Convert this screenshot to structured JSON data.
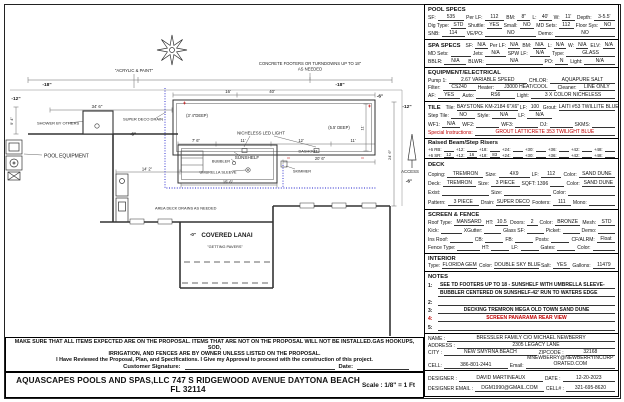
{
  "colors": {
    "red_accent": "#c00000",
    "waterline_blue": "#2020cc"
  },
  "plan": {
    "labels": {
      "acrylic": "\"ACRYLIC & PAINT\"",
      "footers1": "CONCRETE FOOTERS OR TURNDOWNS UP TO 18\"",
      "footers2": "AS NEEDED",
      "m18a": "-18\"",
      "m18b": "-18\"",
      "m12a": "-12\"",
      "m12b": "-12\"",
      "m6a": "-6\"",
      "m6b": "-6\"",
      "m6c": "-6\"",
      "m0": "-0\"",
      "dim346": "34' 6\"",
      "dim40": "40'",
      "dim16": "16'",
      "shower": "SHOWER BY OTHERS",
      "drain": "SUPER DECO DRAIN",
      "poolequip": "POOL EQUIPMENT",
      "deep34": "(3' 4\"DEEP)",
      "deep55": "(5.5' DEEP)",
      "light": "NICHELESS LED LIGHT",
      "dim76": "7' 6\"",
      "dim11a": "11'",
      "dim12": "12'",
      "dim11b": "11'",
      "dim11r": "11'",
      "dashout": "DASHOUT",
      "bubbler": "BUBBLER",
      "sunshelf": "SUNSHELF",
      "dim206": "20' 6\"",
      "umbrella": "UMBRELLA SLEEVE",
      "skimmer": "SKIMMER",
      "dim156": "15' 6\"",
      "deckdrains": "AREA DECK DRAINS AS NEEDED",
      "lanai": "COVERED LANAI",
      "pavers": "\"GETTING PAVERS\"",
      "access": "ACCESS",
      "dim142": "14' 2\"",
      "dim94": "9' 4\"",
      "dim246": "24' 6\""
    }
  },
  "panel": {
    "boxes": [
      {
        "name": "pool-specs",
        "h": 36,
        "title": "POOL SPECS",
        "rows": [
          [
            {
              "l": "SF:",
              "v": "535",
              "f": 1.6
            },
            {
              "l": "Per LF:",
              "v": "112",
              "f": 1.2
            },
            {
              "l": "BM:",
              "v": "8\"",
              "f": 0.8
            },
            {
              "l": "L:",
              "v": "40'",
              "f": 0.8
            },
            {
              "l": "W:",
              "v": "11'",
              "f": 0.8
            },
            {
              "l": "Depth:",
              "v": "3-5.5'",
              "f": 1.3
            }
          ],
          [
            {
              "l": "Dig Type:",
              "v": "STD",
              "f": 1
            },
            {
              "l": "Shuttle:",
              "v": "YES",
              "f": 1
            },
            {
              "l": "Small:",
              "v": "NO",
              "f": 1
            },
            {
              "l": "MD Sets:",
              "v": "112",
              "f": 1
            },
            {
              "l": "Floor Sys:",
              "v": "NO",
              "f": 1
            }
          ],
          [
            {
              "l": "SNB:",
              "v": "114",
              "f": 1
            },
            {
              "l": "VE/PO:",
              "v": "NO",
              "f": 2.2
            },
            {
              "l": "Demo:",
              "v": "NO",
              "f": 2.6
            }
          ]
        ]
      },
      {
        "name": "spa-specs",
        "h": 29,
        "rows": [
          [
            {
              "t": "SPA SPECS"
            },
            {
              "l": "SF:",
              "v": "N/A",
              "f": 1
            },
            {
              "l": "Per LF:",
              "v": "N/A",
              "f": 1
            },
            {
              "l": "BM:",
              "v": "N/A",
              "f": 1
            },
            {
              "l": "L:",
              "v": "N/A",
              "f": 1
            },
            {
              "l": "W:",
              "v": "N/A",
              "f": 1
            },
            {
              "l": "ELV:",
              "v": "N/A",
              "f": 1
            }
          ],
          [
            {
              "l": "MD Sets:",
              "v": "",
              "f": 1
            },
            {
              "l": "Jets:",
              "v": "N/A",
              "f": 1
            },
            {
              "l": "SPW LF:",
              "v": "N/A",
              "f": 1
            },
            {
              "l": "Type:",
              "v": "GLASS",
              "f": 2.4
            }
          ],
          [
            {
              "l": "BBLR:",
              "v": "N/A",
              "f": 1
            },
            {
              "l": "BLWR:",
              "v": "N/A",
              "f": 2.6
            },
            {
              "l": "PO:",
              "v": "N",
              "f": 0.6
            },
            {
              "l": "Light:",
              "v": "N/A",
              "f": 1.4
            }
          ]
        ]
      },
      {
        "name": "equipment-electrical",
        "h": 35,
        "title": "EQUIPMENT/ELECTRICAL",
        "rows": [
          [
            {
              "l": "Pump 1:",
              "v": "2.67 VARIABLE SPEED",
              "f": 2.4
            },
            {
              "l": "CHLOR:",
              "v": "AQUAPURE SALT",
              "f": 2
            }
          ],
          [
            {
              "l": "Filter:",
              "v": "CS240",
              "f": 1
            },
            {
              "l": "Heater:",
              "v": "J3000 HEAT/COOL",
              "f": 1.8
            },
            {
              "l": "Cleaner:",
              "v": "LINE ONLY",
              "f": 1.1
            }
          ],
          [
            {
              "l": "AF:",
              "v": "YES",
              "f": 0.7
            },
            {
              "l": "Auto:",
              "v": "RS6",
              "f": 1.2
            },
            {
              "l": "Light:",
              "v": "3 X COLOR NICHELESS",
              "f": 2.6
            }
          ]
        ]
      },
      {
        "name": "tile",
        "h": 38,
        "rows": [
          [
            {
              "t": "TILE"
            },
            {
              "l": "Tile:",
              "v": "BAYSTONE KM-2184 6\"X6\"",
              "f": 2.6
            },
            {
              "l": "LF:",
              "v": "100",
              "f": 0.5
            },
            {
              "l": "Grout:",
              "v": "LAITI #53 TWILLITE BLUE",
              "f": 2.4
            }
          ],
          [
            {
              "l": "Step Tile:",
              "v": "NO",
              "f": 0.8
            },
            {
              "l": "Style:",
              "v": "N/A",
              "f": 0.8
            },
            {
              "l": "LF:",
              "v": "N/A",
              "f": 0.8
            },
            {
              "l": "",
              "v": "",
              "f": 2
            }
          ],
          [
            {
              "l": "WF1:",
              "v": "N/A",
              "f": 0.8
            },
            {
              "l": "WF2:",
              "v": "",
              "f": 1
            },
            {
              "l": "WF3:",
              "v": "",
              "f": 1
            },
            {
              "l": "DJ:",
              "v": "",
              "f": 1
            },
            {
              "l": "SKMS:",
              "v": "",
              "f": 1
            }
          ],
          [
            {
              "l": "Special Instructions:",
              "lc": "#c00000",
              "v": "GROUT LATTICRETE 353 TWILIGHT BLUE",
              "vc": "#c00000",
              "f": 1
            }
          ]
        ]
      },
      {
        "name": "raised-beam-step-risers",
        "h": 21,
        "title": "Raised Beam/Step Risers",
        "cls": "tiny",
        "rows": [
          [
            {
              "l": "+6 RB:",
              "v": "",
              "f": 1
            },
            {
              "l": "+12:",
              "v": "",
              "f": 1
            },
            {
              "l": "+18:",
              "v": "",
              "f": 1
            },
            {
              "l": "+24:",
              "v": "",
              "f": 1
            },
            {
              "l": "+30:",
              "v": "",
              "f": 1
            },
            {
              "l": "+36:",
              "v": "",
              "f": 1
            },
            {
              "l": "+42:",
              "v": "",
              "f": 1
            },
            {
              "l": "+48:",
              "v": "",
              "f": 1
            }
          ],
          [
            {
              "l": "+6 SR:",
              "v": "12",
              "f": 1
            },
            {
              "l": "+12:",
              "v": "16",
              "f": 1
            },
            {
              "l": "+18:",
              "v": "83",
              "f": 1
            },
            {
              "l": "+24:",
              "v": "",
              "f": 1
            },
            {
              "l": "+30:",
              "v": "",
              "f": 1
            },
            {
              "l": "+36:",
              "v": "",
              "f": 1
            },
            {
              "l": "+42:",
              "v": "",
              "f": 1
            },
            {
              "l": "+48:",
              "v": "",
              "f": 1
            }
          ]
        ]
      },
      {
        "name": "deck",
        "h": 52,
        "title": "DECK",
        "rows": [
          [
            {
              "l": "Coping:",
              "v": "TREMRON",
              "f": 1.4
            },
            {
              "l": "Size:",
              "v": "4X9",
              "f": 1.2
            },
            {
              "l": "LF:",
              "v": "112",
              "f": 0.8
            },
            {
              "l": "Color:",
              "v": "SAND DUNE",
              "f": 1.4
            }
          ],
          [
            {
              "l": "Deck:",
              "v": "TREMRON",
              "f": 1.4
            },
            {
              "l": "Size:",
              "v": "3 PIECE",
              "f": 1.2
            },
            {
              "l": "SQFT: 1396",
              "v": "",
              "f": 0.6
            },
            {
              "l": "Color:",
              "v": "SAND DUNE",
              "f": 1.4
            }
          ],
          [
            {
              "l": "Exist:",
              "v": "",
              "f": 1.4
            },
            {
              "l": "Size:",
              "v": "",
              "f": 1.4
            },
            {
              "l": "Color:",
              "v": "",
              "f": 1.4
            }
          ],
          [
            {
              "l": "Pattern:",
              "v": "3 PIECE",
              "f": 1.2
            },
            {
              "l": "Drain:",
              "v": "SUPER DECO",
              "f": 1.3
            },
            {
              "l": "Footers:",
              "v": "111",
              "f": 0.7
            },
            {
              "l": "Mono:",
              "v": "",
              "f": 1
            }
          ]
        ]
      },
      {
        "name": "screen-fence",
        "h": 45,
        "title": "SCREEN & FENCE",
        "rows": [
          [
            {
              "l": "Roof Type:",
              "v": "MANSARD",
              "f": 1.4
            },
            {
              "l": "HT:",
              "v": "10.5",
              "f": 0.6
            },
            {
              "l": "Doors:",
              "v": "2",
              "f": 0.5
            },
            {
              "l": "Color:",
              "v": "BRONZE",
              "f": 1.2
            },
            {
              "l": "Mesh:",
              "v": "STD",
              "f": 0.8
            }
          ],
          [
            {
              "l": "Kick:",
              "v": "",
              "f": 1
            },
            {
              "l": "XGutter:",
              "v": "",
              "f": 0.8
            },
            {
              "l": "Glass SF:",
              "v": "",
              "f": 0.8
            },
            {
              "l": "Picket:",
              "v": "",
              "f": 0.8
            },
            {
              "l": "Demo:",
              "v": "",
              "f": 0.8
            }
          ],
          [
            {
              "l": "Ins Roof:",
              "v": "",
              "f": 1
            },
            {
              "l": "CB:",
              "v": "",
              "f": 0.8
            },
            {
              "l": "FB:",
              "v": "",
              "f": 0.8
            },
            {
              "l": "Posts:",
              "v": "",
              "f": 0.8
            },
            {
              "l": "CF/ALRM:",
              "v": "Float",
              "f": 0.8
            }
          ],
          [
            {
              "l": "Fence Type:",
              "v": "",
              "f": 1
            },
            {
              "l": "HT:",
              "v": "",
              "f": 0.8
            },
            {
              "l": "LF:",
              "v": "",
              "f": 0.8
            },
            {
              "l": "Gates:",
              "v": "",
              "f": 0.8
            },
            {
              "l": "Color:",
              "v": "",
              "f": 1
            }
          ]
        ]
      },
      {
        "name": "interior",
        "h": 19,
        "title": "INTERIOR",
        "rows": [
          [
            {
              "l": "Type:",
              "v": "FLORIDA GEM",
              "f": 1.4
            },
            {
              "l": "Color:",
              "v": "DOUBLE SKY BLUE",
              "f": 1.8
            },
            {
              "l": "Salt:",
              "v": "YES",
              "f": 0.7
            },
            {
              "l": "Gallons:",
              "v": "11479",
              "f": 0.9
            }
          ]
        ]
      },
      {
        "name": "notes",
        "h": 63,
        "title": "NOTES",
        "notes": [
          {
            "n": "1:",
            "lines": [
              "SEE TD FOOTERS UP TO 18 - SUNSHELF WITH UMBRELLA SLEEVE-",
              "BUBBLER CENTERED ON SUNSHELF-42' RUN TO WATERS EDGE"
            ],
            "bold": true
          },
          {
            "n": "2:",
            "lines": [
              ""
            ]
          },
          {
            "n": "3:",
            "lines": [
              "DECKING TREMRON MEGA OLD TOWN SAND DUNE"
            ],
            "bold": true,
            "center": true
          },
          {
            "n": "4:",
            "lines": [
              "SCREEN PANARAMA REAR VIEW"
            ],
            "bold": true,
            "center": true,
            "color": "#c00000"
          },
          {
            "n": "5:",
            "lines": [
              ""
            ]
          }
        ]
      },
      {
        "name": "customer",
        "h": 38,
        "rows": [
          [
            {
              "l": "NAME :",
              "v": "BRESSLER FAMILY C/O MICHAEL NEWBERRY",
              "f": 1
            }
          ],
          [
            {
              "l": "ADDRESS :",
              "v": "2305 LEGACY LANE",
              "f": 1
            }
          ],
          [
            {
              "l": "CITY :",
              "v": "NEW SMYRNA BEACH",
              "f": 1.5
            },
            {
              "l": "ZIPCODE :",
              "v": "32168",
              "f": 0.8
            }
          ],
          [
            {
              "l": "CELL:",
              "v": "386-801-2441",
              "f": 1
            },
            {
              "l": "Email:",
              "v": "MNEWBERRY@NEWBERRYINCORPORATED.COM",
              "f": 1.4,
              "wrap": true
            }
          ]
        ]
      },
      {
        "name": "designer",
        "h": 27,
        "rows": [
          [
            {
              "l": "DESIGNER :",
              "v": "DAVID MARTINEAUX",
              "f": 1.6
            },
            {
              "l": "DATE :",
              "v": "12-20-2023",
              "f": 1
            }
          ],
          [
            {
              "l": "DESIGNER EMAIL :",
              "v": "DGM1990@GMAIL.COM",
              "f": 1.4
            },
            {
              "l": "CELL# :",
              "v": "321-695-8620",
              "f": 1
            }
          ]
        ]
      }
    ]
  },
  "disclaimer": {
    "line1": "MAKE SURE THAT ALL ITEMS EXPECTED ARE ON THE PROPOSAL.  ITEMS THAT ARE NOT ON THE PROPOSAL WILL NOT BE INSTALLED.GAS HOOKUPS, SOD,",
    "line2": "IRRIGATION, AND FENCES ARE BY OWNER UNLESS LISTED ON THE PROPOSAL.",
    "line3": "I Have Reviewed the Proposal, Plan, and Specifications. I Give my Approval to proceed with the construction of this project.",
    "signature_label": "Customer Signature:",
    "date_label": "Date:"
  },
  "footer": {
    "company": "AQUASCAPES POOLS AND SPAS,LLC 747 S RIDGEWOOD AVENUE DAYTONA  BEACH FL 32114",
    "scale": "Scale : 1/8\" = 1 Ft"
  }
}
